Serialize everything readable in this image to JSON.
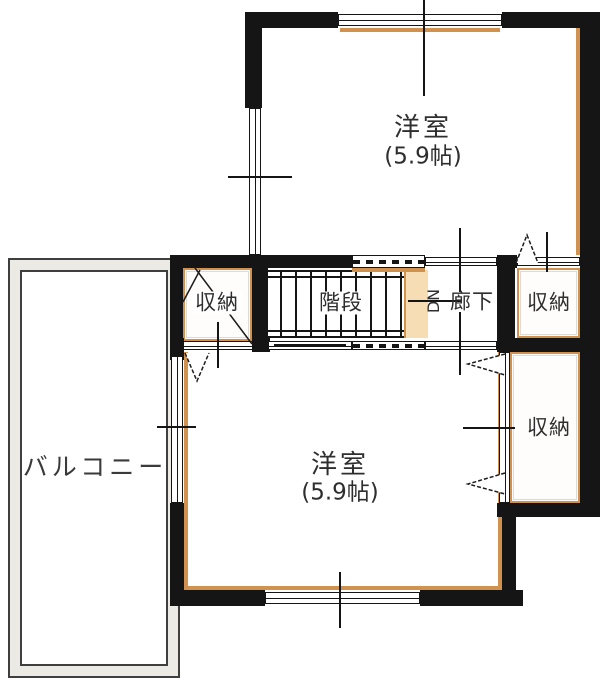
{
  "plan_title": "2F floor plan",
  "colors": {
    "wall": "#151515",
    "accent": "#d1914f",
    "accent_pale": "#f6ddb4",
    "balcony_line": "#3f3f3f",
    "text": "#2e2e2e"
  },
  "labels": {
    "bedroom_top": {
      "name": "洋室",
      "size": "(5.9帖)"
    },
    "bedroom_bottom": {
      "name": "洋室",
      "size": "(5.9帖)"
    },
    "stairs": {
      "name": "階段"
    },
    "hallway": {
      "dn": "DN",
      "name": "廊下"
    },
    "closet_mid_left": {
      "name": "収納"
    },
    "closet_mid_right": {
      "name": "収納"
    },
    "closet_bottom_right": {
      "name": "収納"
    },
    "balcony": {
      "name": "バルコニー"
    }
  }
}
